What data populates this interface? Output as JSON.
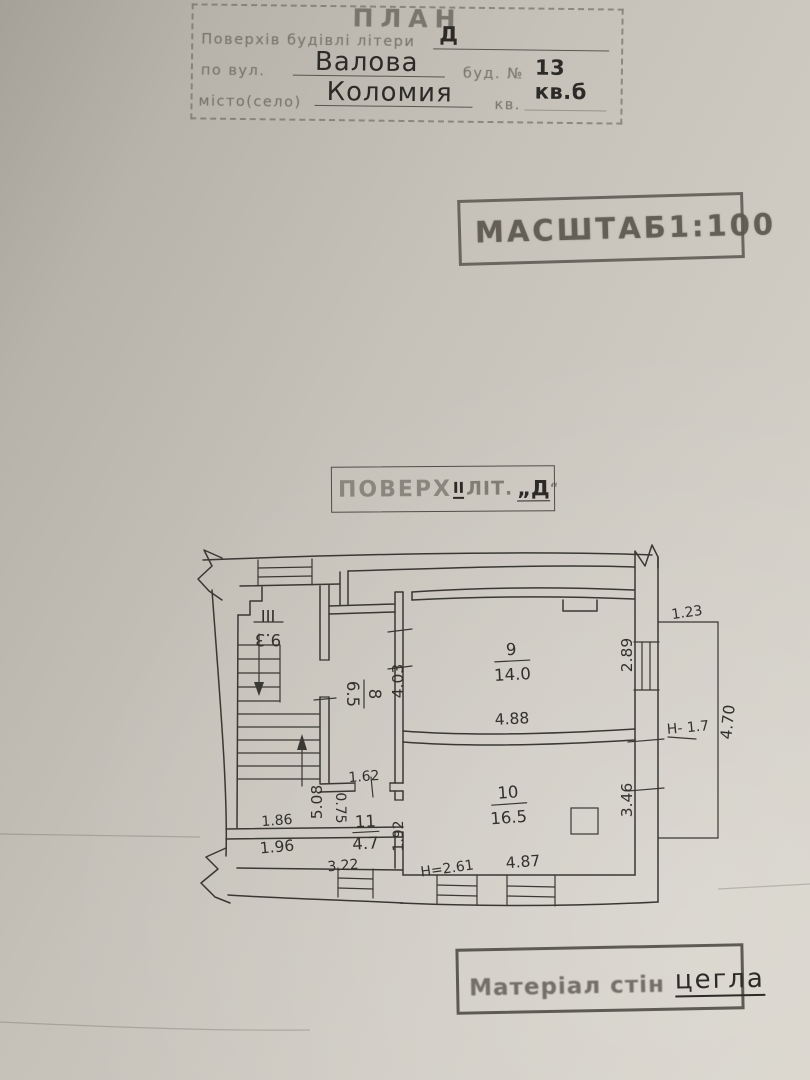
{
  "colors": {
    "paper": "#cfcbc3",
    "stamp_ink": "#5d5950",
    "hand_ink": "#2d2b27",
    "plan_ink": "#3a3833"
  },
  "header_stamp": {
    "title": "ПЛАН",
    "line1_label": "Поверхів будівлі літери",
    "line1_value": "Д",
    "line2_label": "по вул.",
    "line2_value": "Валова",
    "line2b_label": "буд. №",
    "line2b_value": "13 кв.б",
    "line3_label": "місто(село)",
    "line3_value": "Коломия",
    "line3b_label": "кв."
  },
  "scale_stamp": {
    "word": "МАСШТАБ",
    "ratio": "1:100"
  },
  "floor_stamp": {
    "label": "ПОВЕРХ",
    "floor_value": "ІІ",
    "lit_label": "ЛІТ.",
    "lit_value": "„Д",
    "quote": "“"
  },
  "material_stamp": {
    "label": "Матеріал стін",
    "value": "цегла"
  },
  "plan": {
    "rooms": [
      {
        "number": "ІІІ",
        "area": "9.3"
      },
      {
        "number": "8",
        "area": "6.5"
      },
      {
        "number": "9",
        "area": "14.0"
      },
      {
        "number": "10",
        "area": "16.5"
      },
      {
        "number": "11",
        "area": "4.7"
      }
    ],
    "dims": {
      "room8_height": "4.03",
      "room9_width": "4.88",
      "room9_right": "2.89",
      "balcony_width": "1.23",
      "balcony_h_note": "Н- 1.7",
      "balcony_length": "4.70",
      "room10_right": "3.46",
      "room10_width": "4.87",
      "room10_h_note": "Н=2.61",
      "hall_162": "1.62",
      "hall_075": "0.75",
      "room11_right": "1.92",
      "stair_508": "5.08",
      "landing_186": "1.86",
      "corridor_196": "1.96",
      "corridor_322": "3.22"
    }
  }
}
